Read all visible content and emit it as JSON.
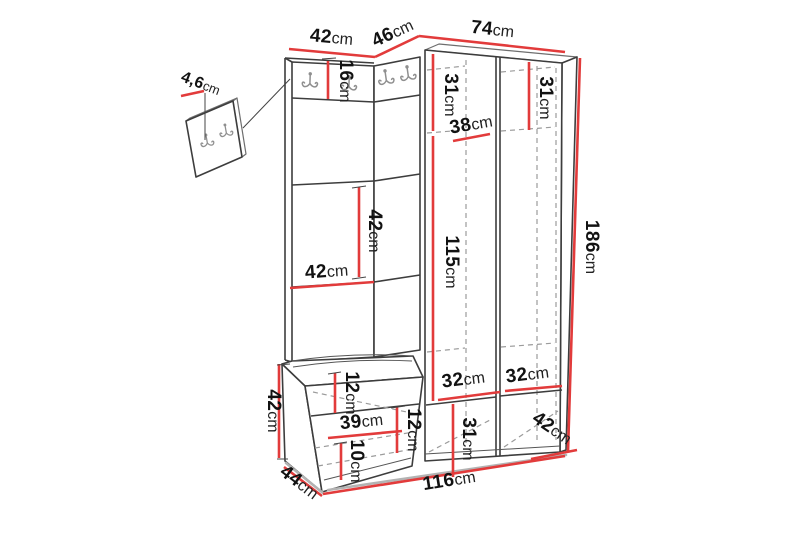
{
  "meta": {
    "description": "Hallway furniture set dimension diagram: corner wardrobe with coat-hook panels, mirror panel and storage bench",
    "background": "#ffffff"
  },
  "colors": {
    "dimension_line": "#e23b3b",
    "outline": "#3d3d3d",
    "dashed_line": "#9b9b9b",
    "hook": "#8f8f8f",
    "label": "#121212"
  },
  "dims": {
    "top_left_width": {
      "value": "42",
      "unit": "cm"
    },
    "top_mid_width": {
      "value": "46",
      "unit": "cm"
    },
    "top_right_width": {
      "value": "74",
      "unit": "cm"
    },
    "panel_thickness": {
      "value": "4,6",
      "unit": "cm"
    },
    "hook_strip_height": {
      "value": "16",
      "unit": "cm"
    },
    "left_shelf_height": {
      "value": "31",
      "unit": "cm"
    },
    "right_shelf_height": {
      "value": "31",
      "unit": "cm"
    },
    "interior_width": {
      "value": "38",
      "unit": "cm"
    },
    "hanging_height": {
      "value": "115",
      "unit": "cm"
    },
    "total_height": {
      "value": "186",
      "unit": "cm"
    },
    "mirror_section_height": {
      "value": "42",
      "unit": "cm"
    },
    "mirror_section_width": {
      "value": "42",
      "unit": "cm"
    },
    "bench_height": {
      "value": "42",
      "unit": "cm"
    },
    "seat_thickness": {
      "value": "12",
      "unit": "cm"
    },
    "drawer_width": {
      "value": "39",
      "unit": "cm"
    },
    "drawer_height": {
      "value": "12",
      "unit": "cm"
    },
    "plinth_height": {
      "value": "10",
      "unit": "cm"
    },
    "bench_depth": {
      "value": "44",
      "unit": "cm"
    },
    "total_width": {
      "value": "116",
      "unit": "cm"
    },
    "left_cubby_width": {
      "value": "32",
      "unit": "cm"
    },
    "right_cubby_width": {
      "value": "32",
      "unit": "cm"
    },
    "cubby_height": {
      "value": "31",
      "unit": "cm"
    },
    "wardrobe_depth": {
      "value": "42",
      "unit": "cm"
    }
  }
}
